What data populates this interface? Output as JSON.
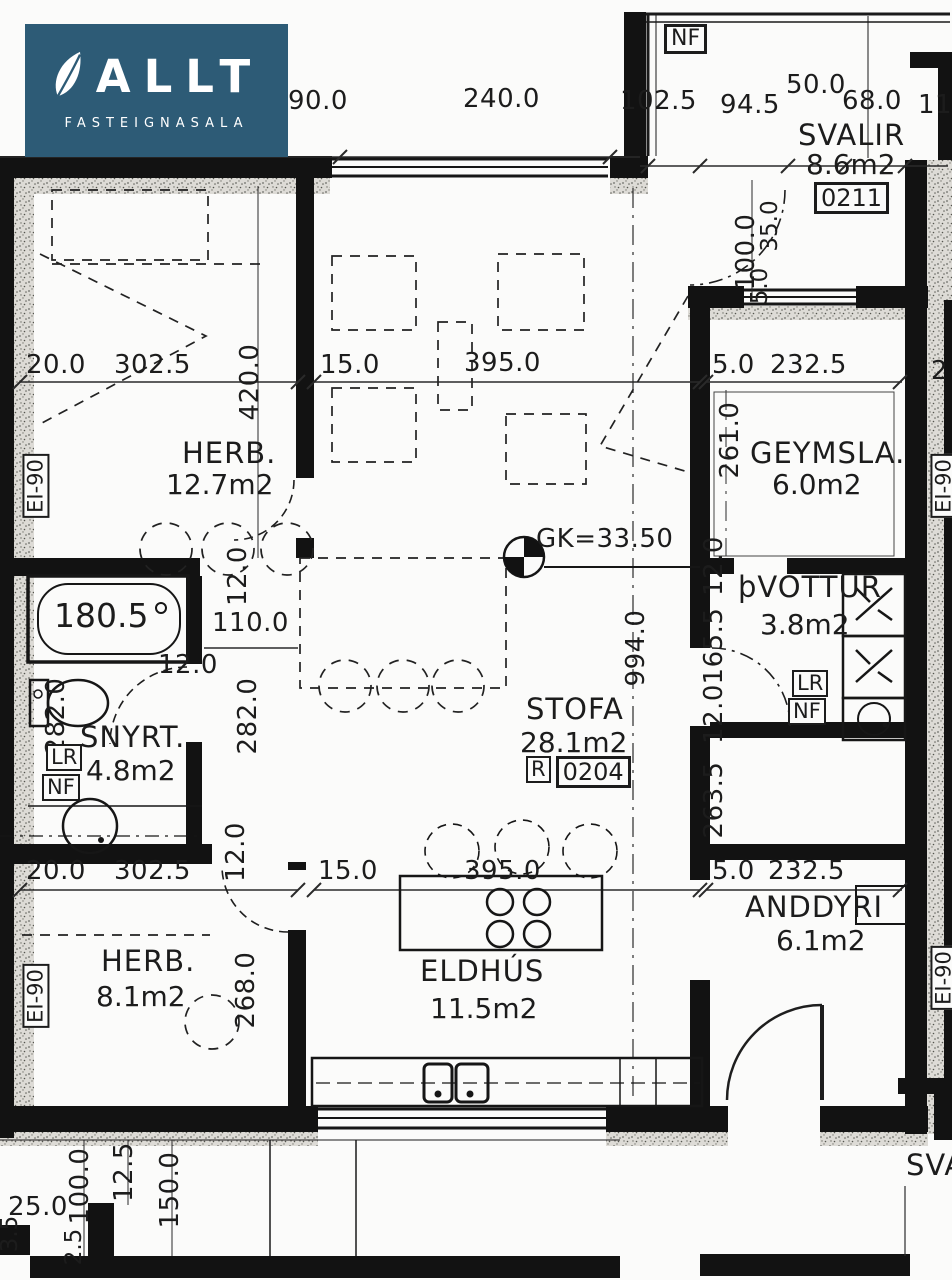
{
  "logo": {
    "brand": "ALLT",
    "subtitle": "FASTEIGNASALA",
    "bg": "#2d5b76"
  },
  "colors": {
    "ink": "#1c1c1c",
    "paper": "#fbfbfa",
    "logo_bg": "#2d5b76"
  },
  "plan": {
    "dims_top": {
      "d90": "90.0",
      "d240": "240.0",
      "d102": "102.5",
      "d94": "94.5",
      "d50": "50.0",
      "d68": "68.0",
      "d11": "11"
    },
    "svalir": {
      "nf": "NF",
      "name": "SVALIR",
      "area": "8.6m2",
      "unit": "0211",
      "v100": "100.0",
      "v35": "35.0",
      "v5": "5.0"
    },
    "herb1": {
      "name": "HERB.",
      "area": "12.7m2",
      "d20": "20.0",
      "d302": "302.5",
      "v420": "420.0",
      "fire": "EI-90"
    },
    "stofa": {
      "name": "STOFA",
      "area": "28.1m2",
      "rlabel": "R",
      "unit": "0204",
      "d15": "15.0",
      "d395": "395.0",
      "v994": "994.0",
      "gk": "GK=33.50"
    },
    "geymsla": {
      "name": "GEYMSLA.",
      "area": "6.0m2",
      "d5": "5.0",
      "d232": "232.5",
      "v261": "261.0"
    },
    "thvottur": {
      "name": "þVOTTUR",
      "area": "3.8m2",
      "lr": "LR",
      "nf": "NF"
    },
    "corridor": {
      "v12a": "12.0",
      "v165": "165.5",
      "v12b": "12.0",
      "v263": "263.5"
    },
    "snyrt": {
      "name": "SNYRT.",
      "area": "4.8m2",
      "tub": "180.5",
      "lr": "LR",
      "nf": "NF",
      "d110": "110.0",
      "v12top": "12.0",
      "d12": "12.0",
      "v282l": "282.0",
      "v282r": "282.0",
      "v12bot": "12.0"
    },
    "herb2": {
      "name": "HERB.",
      "area": "8.1m2",
      "d20": "20.0",
      "d302": "302.5",
      "v268": "268.0",
      "fire": "EI-90"
    },
    "eldhus": {
      "name": "ELDHÚS",
      "area": "11.5m2",
      "d15": "15.0",
      "d395": "395.0"
    },
    "anddyri": {
      "name": "ANDDYRI",
      "area": "6.1m2",
      "d5": "5.0",
      "d232": "232.5"
    },
    "bottom": {
      "d25": "25.0",
      "v100": "100.0",
      "v12": "12.5",
      "v150": "150.0",
      "v2": "2.5",
      "v3": "3.5"
    },
    "right_edge": {
      "fire1": "EI-90",
      "fire2": "EI-90",
      "p2": "2",
      "sva": "SVA"
    }
  }
}
